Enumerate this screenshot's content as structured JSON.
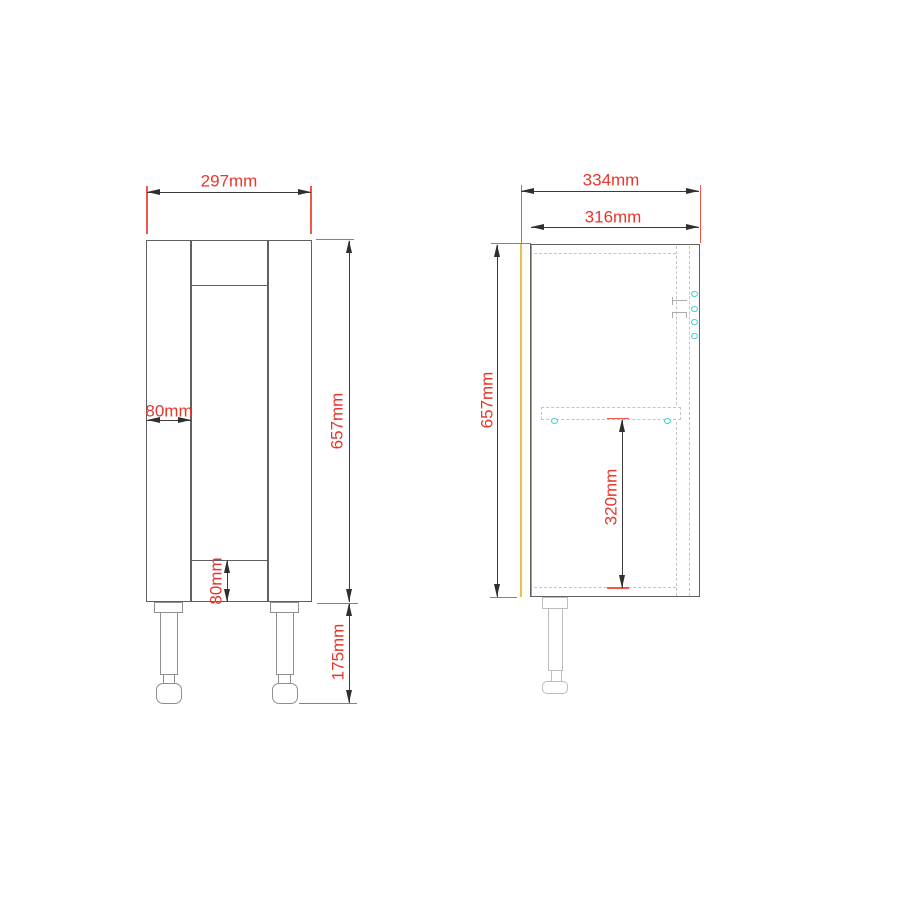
{
  "page": {
    "background": "#ffffff",
    "content": "cabinet technical dimension drawing, front elevation and side section"
  },
  "front_view": {
    "dimensions": {
      "overall_width": "297mm",
      "stile_width": "80mm",
      "height": "657mm",
      "bottom_rail": "80mm",
      "leg_height": "175mm"
    }
  },
  "side_view": {
    "dimensions": {
      "overall_depth": "334mm",
      "internal_depth": "316mm",
      "height": "657mm",
      "shelf_to_base": "320mm"
    }
  },
  "colors": {
    "dimension_text": "#e8362b",
    "extension_line": "#f0564a",
    "outline": "#606060",
    "dimension_line": "#3a3a3a",
    "hidden_line": "#c4c4c4",
    "front_leg_outline": "#8f8f8f",
    "side_leg_outline": "#bdbdbd",
    "door_edge_front": "#e5c153",
    "door_edge_back": "#c09b4e",
    "fitting_marker": "#3fd2d2"
  }
}
